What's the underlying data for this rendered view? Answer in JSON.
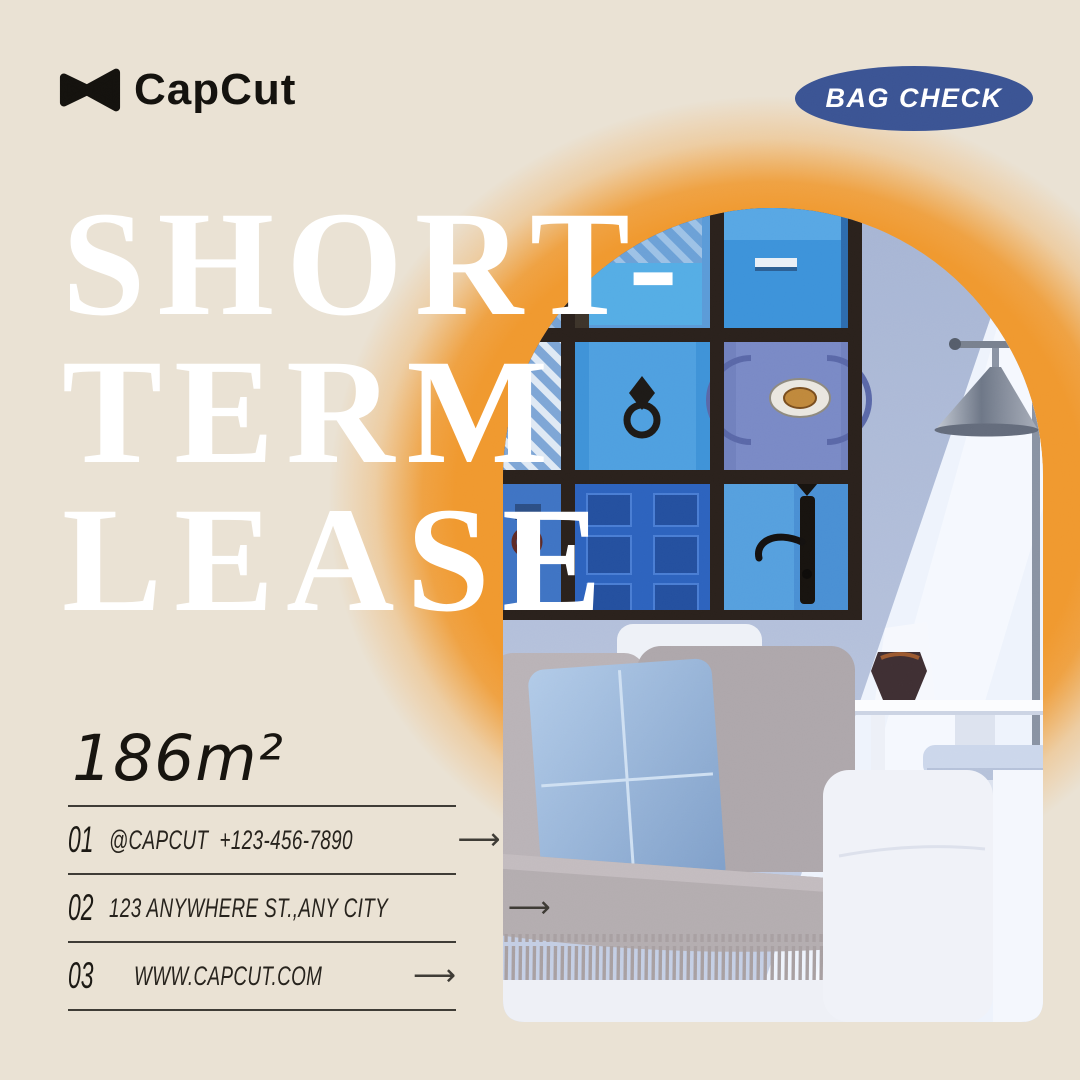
{
  "canvas": {
    "background": "#EAE2D4"
  },
  "brand": {
    "name": "CapCut",
    "icon": "capcut-bowtie-icon",
    "color": "#14120E"
  },
  "badge": {
    "label": "BAG CHECK",
    "bg_color": "#3B5494",
    "text_color": "#FFFFFF"
  },
  "headline": {
    "lines": [
      "SHORT-",
      "TERM",
      "LEASE"
    ],
    "color": "#FFFFFF"
  },
  "area_label": "186m²",
  "contact": {
    "rows": [
      {
        "num": "01",
        "label": "@CAPCUT  +123-456-7890"
      },
      {
        "num": "02",
        "label": "123 ANYWHERE ST.,ANY CITY"
      },
      {
        "num": "03",
        "label": "WWW.CAPCUT.COM"
      }
    ],
    "arrow_glyph": "⟶",
    "line_color": "#3E3B35"
  },
  "photo": {
    "shape": "arch",
    "subject": "living room with blue-door gallery wall, floor lamp and white sofa",
    "glow_color": "#F0992F",
    "wall_color": "#ACBAD8"
  }
}
